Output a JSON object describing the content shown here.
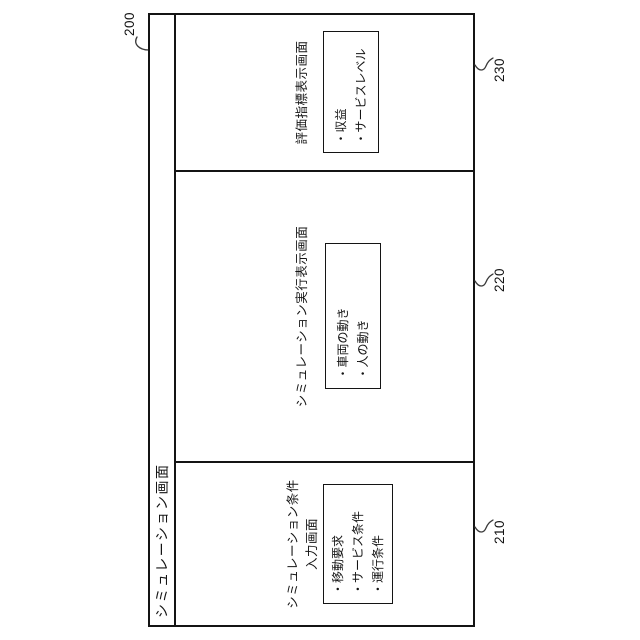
{
  "figure": {
    "ref_screen": "200",
    "title": "シミュレーション画面",
    "colors": {
      "line": "#141414",
      "background": "#ffffff"
    },
    "sections": [
      {
        "ref": "210",
        "heading1": "シミュレーション条件",
        "heading2": "入力画面",
        "items": [
          "・移動要求",
          "・サービス条件",
          "・運行条件"
        ]
      },
      {
        "ref": "220",
        "heading1": "シミュレーション実行表示画面",
        "heading2": "",
        "items": [
          "・車両の動き",
          "・人の動き"
        ]
      },
      {
        "ref": "230",
        "heading1": "評価指標表示画面",
        "heading2": "",
        "items": [
          "・収益",
          "・サービスレベル"
        ]
      }
    ]
  }
}
